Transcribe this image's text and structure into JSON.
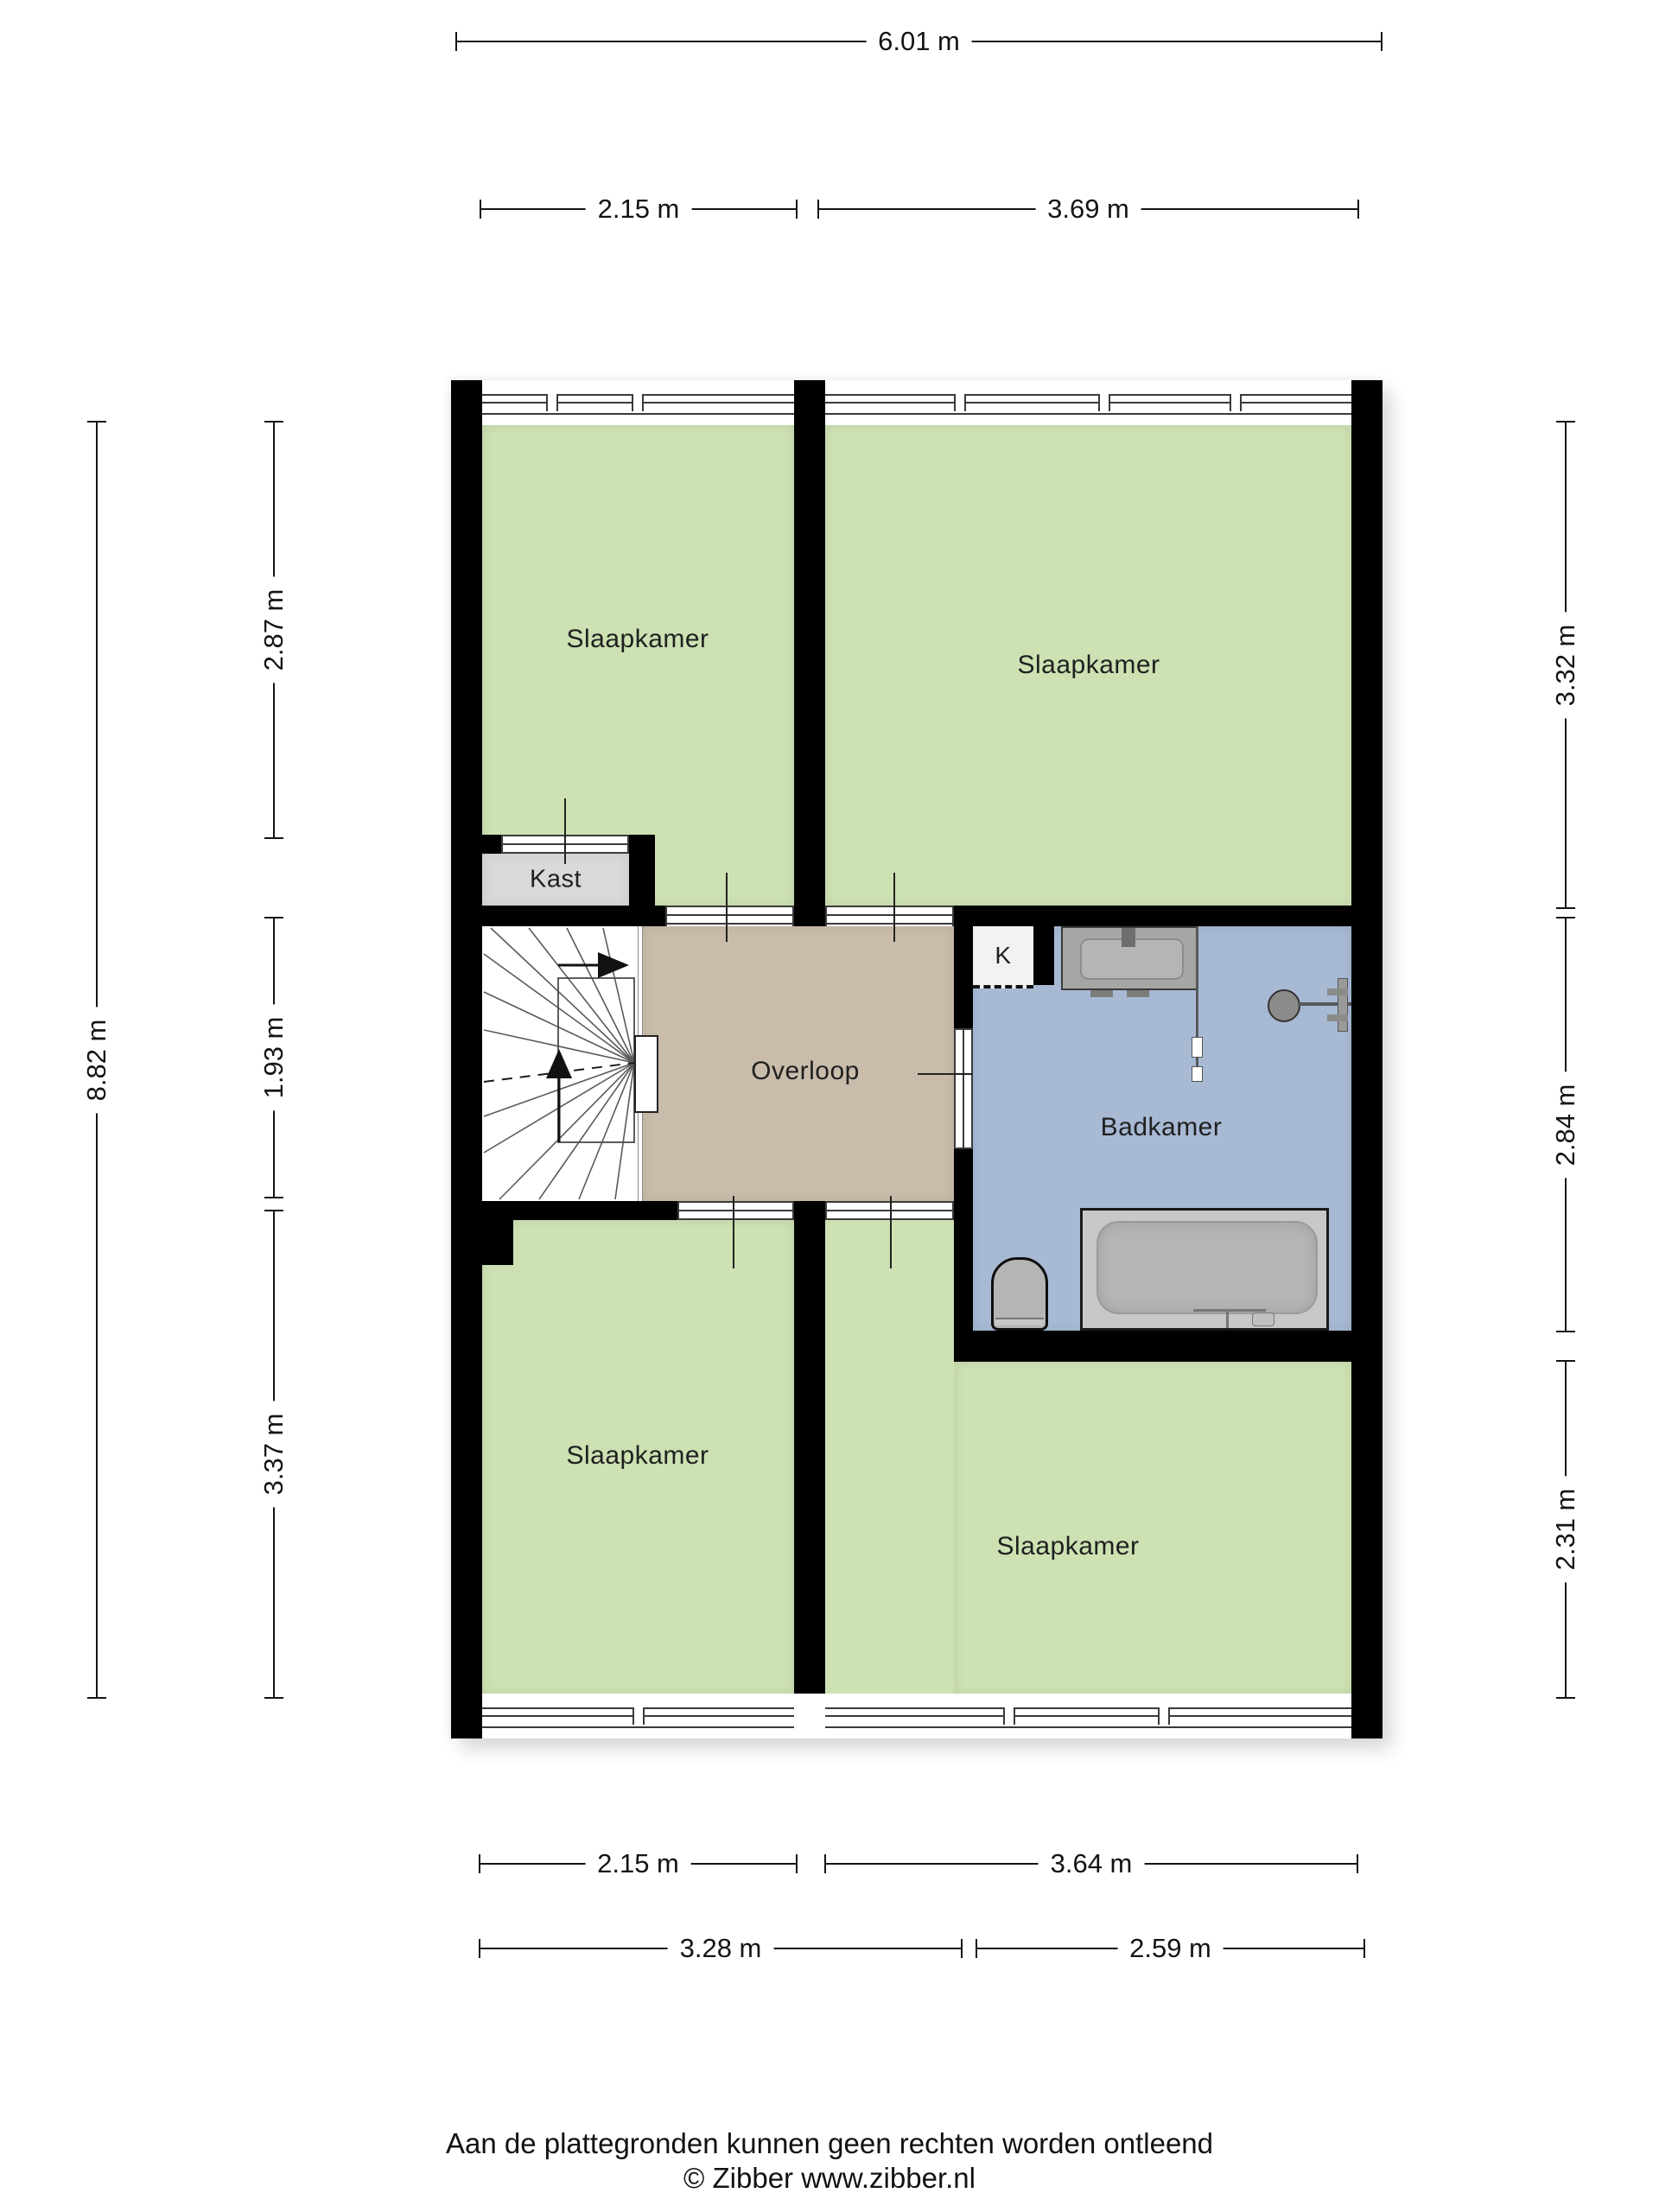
{
  "rooms": {
    "slaapkamer_top_left": "Slaapkamer",
    "slaapkamer_top_right": "Slaapkamer",
    "slaapkamer_bottom_left": "Slaapkamer",
    "slaapkamer_bottom_right": "Slaapkamer",
    "hallway": "Overloop",
    "bathroom": "Badkamer",
    "closet": "Kast",
    "small_closet": "K"
  },
  "dimensions": {
    "total_width": "6.01 m",
    "top_left_width": "2.15 m",
    "top_right_width": "3.69 m",
    "total_height": "8.82 m",
    "left_top": "2.87 m",
    "left_middle": "1.93 m",
    "left_bottom": "3.37 m",
    "right_top": "3.32 m",
    "right_middle": "2.84 m",
    "right_bottom": "2.31 m",
    "bottom_left_width": "2.15 m",
    "bottom_right_width": "3.64 m",
    "bottom_row2_left": "3.28 m",
    "bottom_row2_right": "2.59 m"
  },
  "footer": {
    "disclaimer": "Aan de plattegronden kunnen geen rechten worden ontleend",
    "copyright": "© Zibber www.zibber.nl"
  },
  "colors": {
    "wall": "#000000",
    "room_green": "#cde1b3",
    "hall_tan": "#c9bcab",
    "bath_blue": "#a7b9d3",
    "closet_gray": "#d9d9d7",
    "glaze_line": "#3a3a3a",
    "outline_dark": "#222222",
    "dim_color": "#141414",
    "label_color": "#202020",
    "fixture_gray": "#b5b5b3",
    "fixture_gray_dark": "#8d8d8b",
    "fixture_gray_light": "#c7c7c5"
  }
}
